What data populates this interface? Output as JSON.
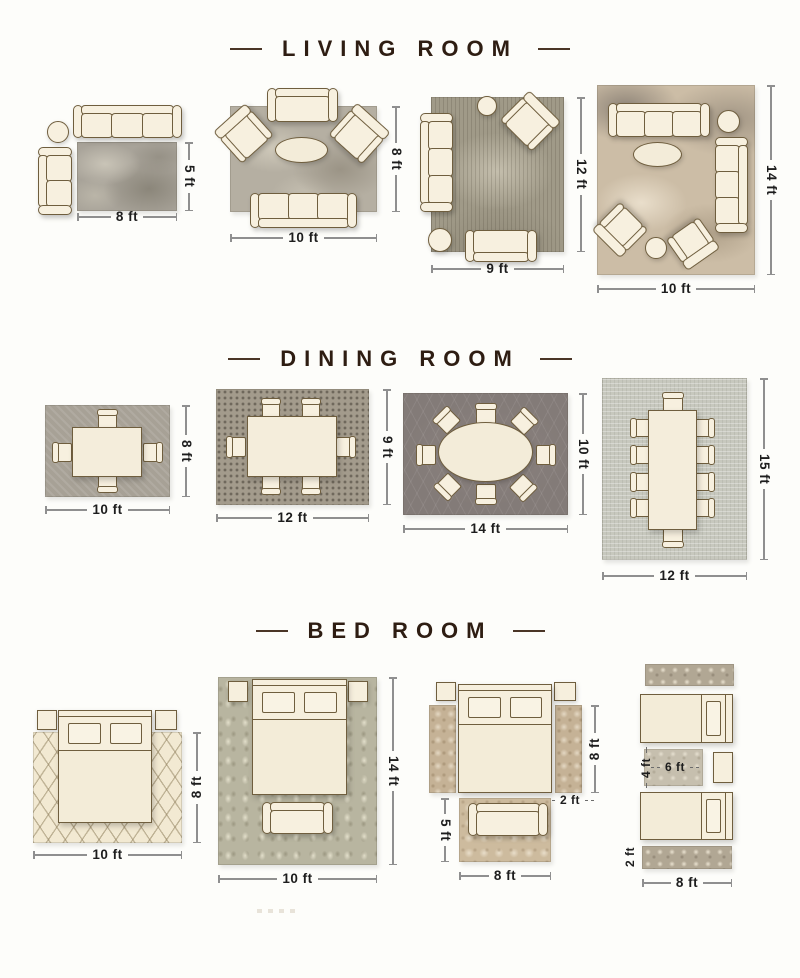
{
  "palette": {
    "background": "#fdfdfa",
    "heading_text": "#2e1d12",
    "dimension_text": "#1d1d1d",
    "dimension_line": "#8f8f8f",
    "furniture_fill": "#f7f0df",
    "furniture_outline": "#6f5e3e"
  },
  "sections": [
    {
      "title": "LIVING ROOM",
      "layouts": [
        {
          "name": "living-rug-8x5",
          "bottom_label": "8 ft",
          "side_label": "5 ft",
          "rug_color": "#a8a399",
          "furniture": [
            "sofa",
            "chaise",
            "side-table",
            "rug"
          ]
        },
        {
          "name": "living-rug-10x8",
          "bottom_label": "10 ft",
          "side_label": "8 ft",
          "rug_color": "#b5afa2",
          "furniture": [
            "sofa",
            "sofa",
            "armchair",
            "armchair",
            "oval-coffee-table",
            "rug"
          ]
        },
        {
          "name": "living-rug-9x12",
          "bottom_label": "9 ft",
          "side_label": "12 ft",
          "rug_color": "#a09a88",
          "furniture": [
            "sofa",
            "loveseat",
            "armchair",
            "side-table",
            "ottoman",
            "rug"
          ]
        },
        {
          "name": "living-rug-10x14",
          "bottom_label": "10 ft",
          "side_label": "14 ft",
          "rug_color": "#ccbda6",
          "furniture": [
            "sofa",
            "sofa",
            "armchair",
            "armchair",
            "oval-coffee-table",
            "side-table",
            "ottoman",
            "rug"
          ]
        }
      ]
    },
    {
      "title": "DINING ROOM",
      "layouts": [
        {
          "name": "dining-rug-10x8",
          "bottom_label": "10 ft",
          "side_label": "8 ft",
          "rug_color": "#a7a196",
          "furniture": [
            "square-table",
            "4-chairs",
            "rug"
          ]
        },
        {
          "name": "dining-rug-12x9",
          "bottom_label": "12 ft",
          "side_label": "9 ft",
          "rug_color": "#a39b8c",
          "furniture": [
            "rectangular-table",
            "6-chairs",
            "rug"
          ]
        },
        {
          "name": "dining-rug-14x10",
          "bottom_label": "14 ft",
          "side_label": "10 ft",
          "rug_color": "#837b78",
          "furniture": [
            "oval-table",
            "8-chairs",
            "rug"
          ]
        },
        {
          "name": "dining-rug-12x15",
          "bottom_label": "12 ft",
          "side_label": "15 ft",
          "rug_color": "#c7c8be",
          "furniture": [
            "long-table",
            "10-chairs",
            "rug"
          ]
        }
      ]
    },
    {
      "title": "BED ROOM",
      "layouts": [
        {
          "name": "bed-rug-10x8",
          "bottom_label": "10 ft",
          "side_label": "8 ft",
          "rug_color": "#f2e9d2",
          "furniture": [
            "bed",
            "nightstand",
            "nightstand",
            "rug"
          ]
        },
        {
          "name": "bed-rug-10x14",
          "bottom_label": "10 ft",
          "side_label": "14 ft",
          "rug_color": "#b8b5a0",
          "furniture": [
            "bed",
            "nightstand",
            "nightstand",
            "bench",
            "rug"
          ]
        },
        {
          "name": "bed-runners-and-foot-rug",
          "bottom_label": "8 ft",
          "side_label": "8 ft",
          "gap_label": "2 ft",
          "foot_side_label": "5 ft",
          "rug_color": "#c5b296",
          "furniture": [
            "bed",
            "nightstand",
            "nightstand",
            "runner-rug",
            "runner-rug",
            "bench",
            "foot-rug"
          ]
        },
        {
          "name": "bed-twin-runners",
          "bottom_label": "8 ft",
          "mid_side_label": "4 ft",
          "mid_width_label": "6 ft",
          "runner_side_label": "2 ft",
          "rug_color": "#b1a794",
          "furniture": [
            "twin-bed",
            "twin-bed",
            "nightstand",
            "runner-rug",
            "runner-rug",
            "center-rug"
          ]
        }
      ]
    }
  ]
}
